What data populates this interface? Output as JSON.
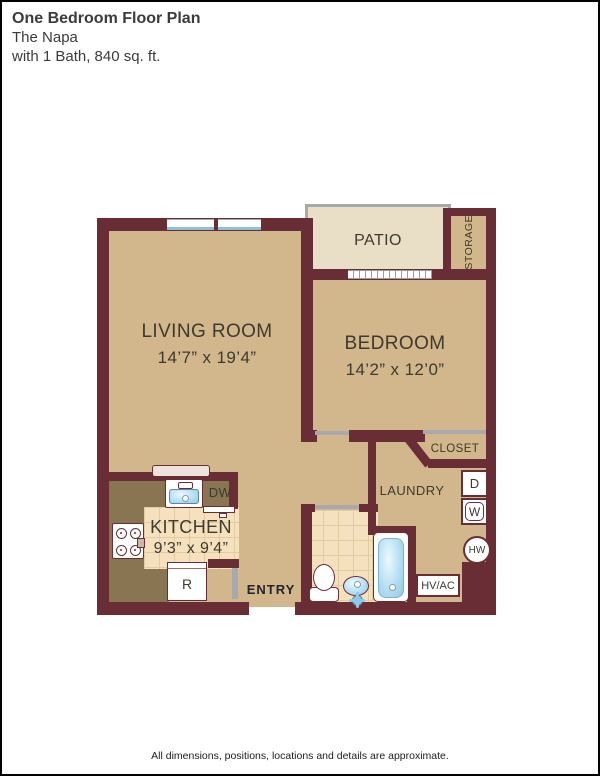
{
  "header": {
    "title": "One Bedroom Floor Plan",
    "subtitle": "The Napa",
    "details": "with 1 Bath, 840 sq. ft."
  },
  "rooms": {
    "living": {
      "name": "LIVING ROOM",
      "dims": "14’7” x 19’4”"
    },
    "bedroom": {
      "name": "BEDROOM",
      "dims": "14’2” x 12’0”"
    },
    "kitchen": {
      "name": "KITCHEN",
      "dims": "9’3” x 9’4”"
    },
    "patio": {
      "name": "PATIO"
    },
    "storage": {
      "name": "STORAGE"
    },
    "closet": {
      "name": "CLOSET"
    },
    "laundry": {
      "name": "LAUNDRY"
    },
    "entry": {
      "name": "ENTRY"
    }
  },
  "appliances": {
    "dishwasher": "DW",
    "refrigerator": "R",
    "dryer": "D",
    "washer": "W",
    "water_heater": "HW",
    "hvac": "HV/AC"
  },
  "colors": {
    "wall": "#692d35",
    "floor_tan": "#d2b68c",
    "patio_cream": "#e9dfc6",
    "tile": "#f5e1bd",
    "counter": "#8a7553",
    "railing_gray": "#a7a9ac",
    "fixture_blue": "#8ec9e9"
  },
  "footer": {
    "disclaimer": "All dimensions, positions, locations and details are approximate."
  }
}
